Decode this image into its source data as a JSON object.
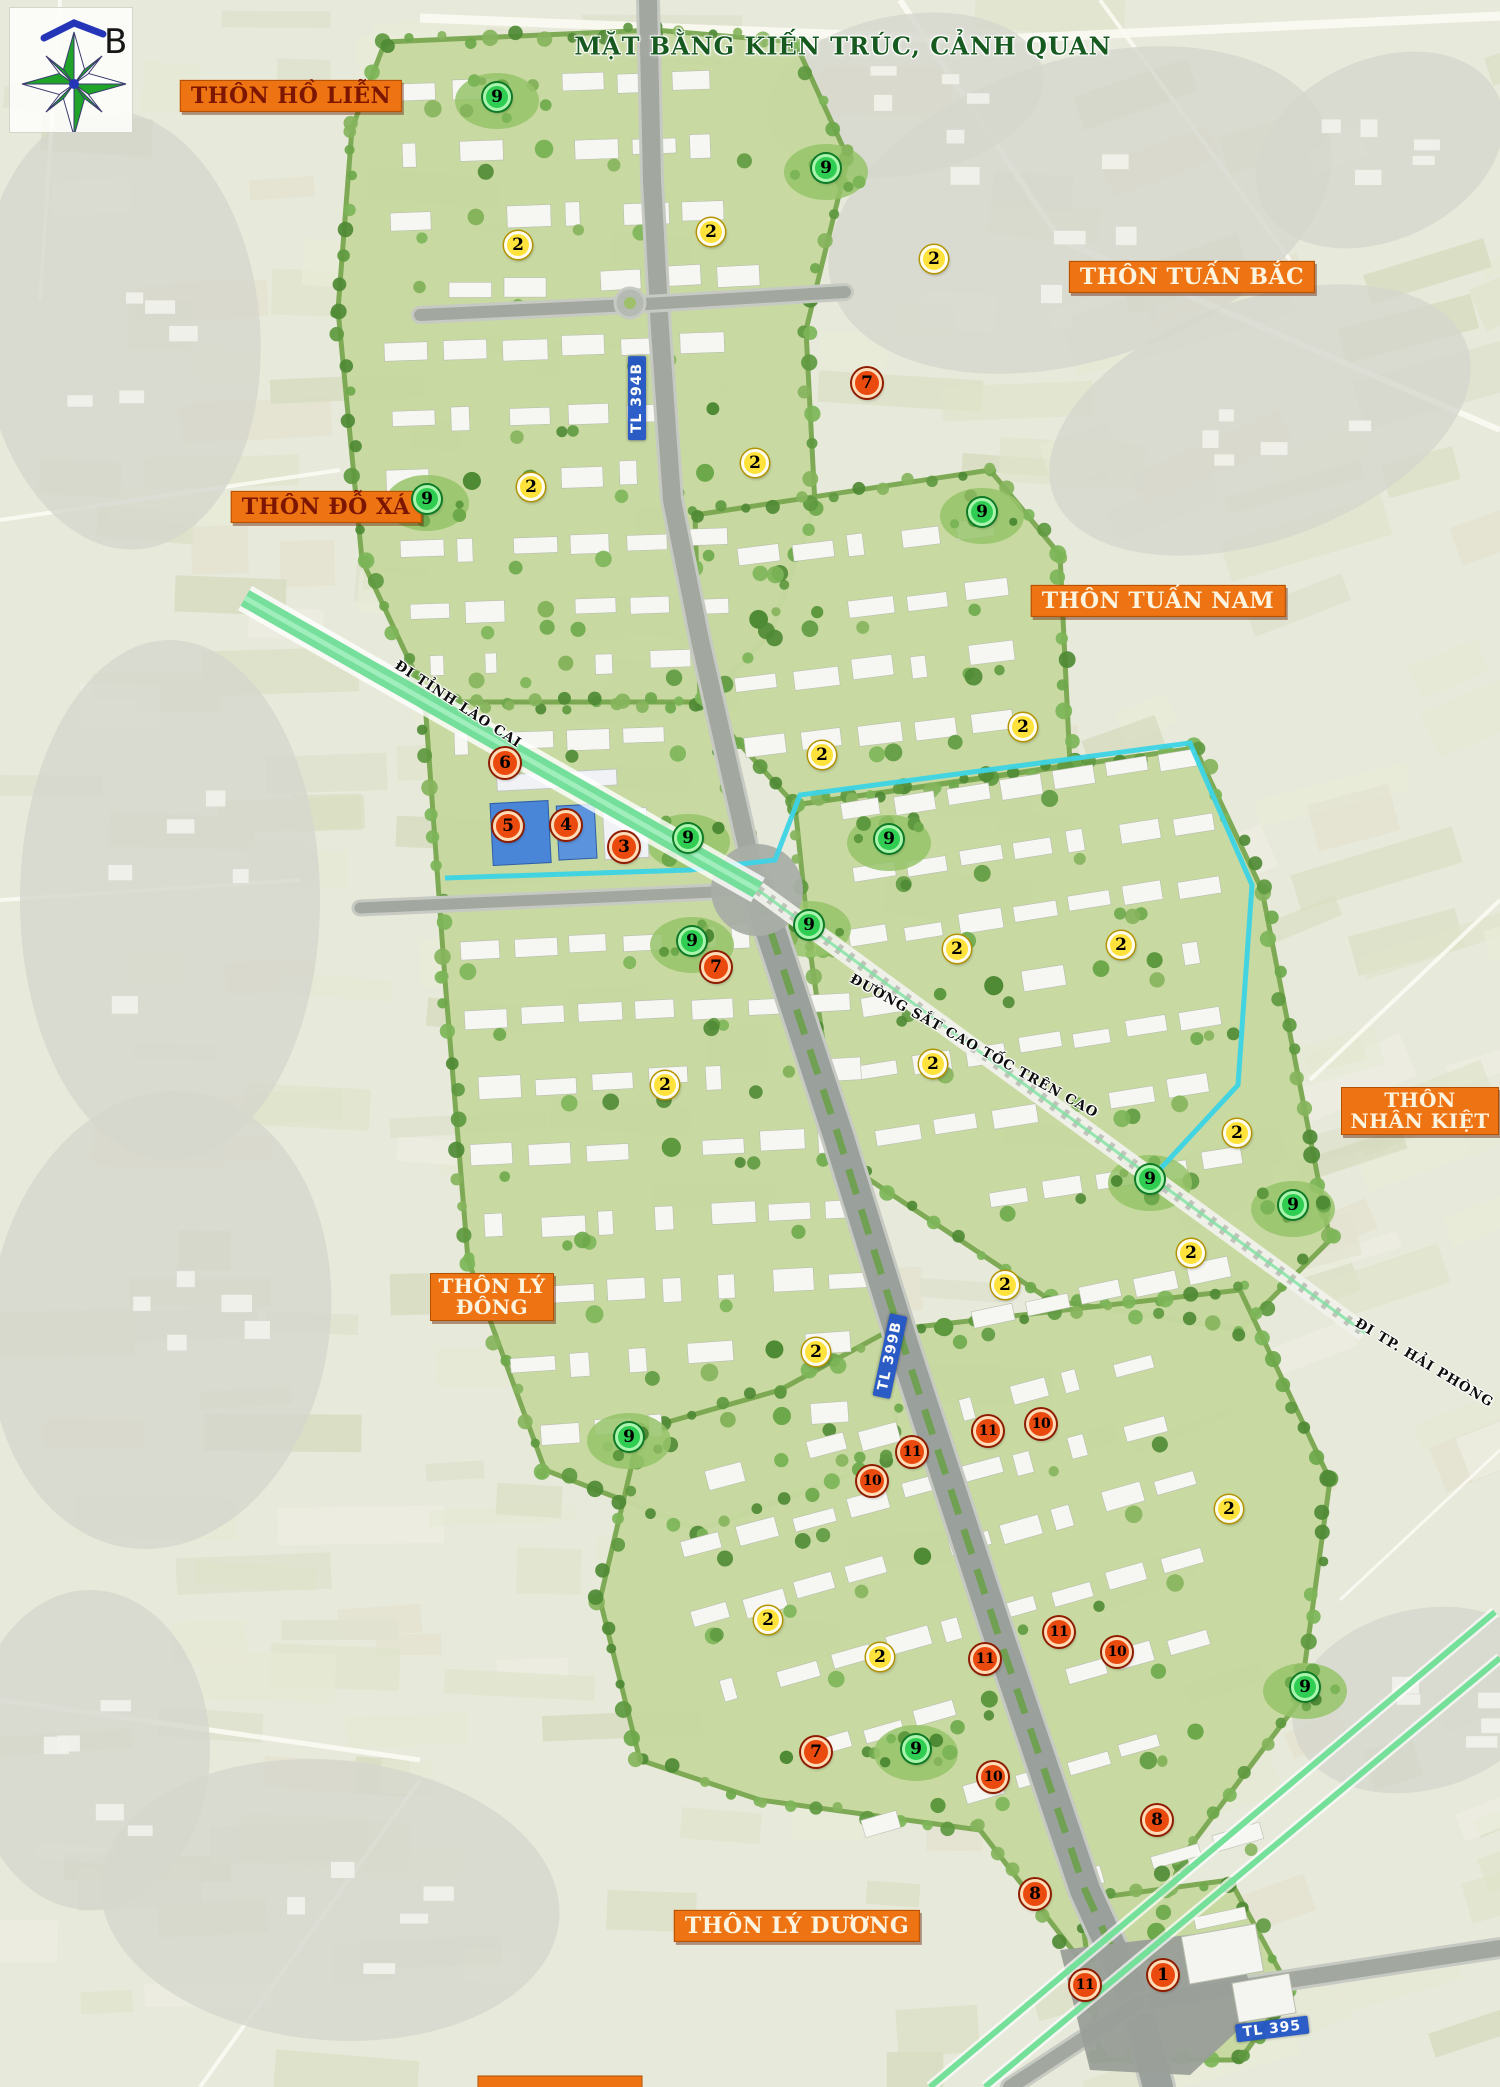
{
  "title": "MẶT BẰNG KIẾN TRÚC, CẢNH QUAN",
  "compass": {
    "north_label": "B"
  },
  "village_labels": [
    {
      "text": "THÔN HỒ LIỄN",
      "x": 291,
      "y": 96,
      "variant": "dark",
      "two_line": false
    },
    {
      "text": "THÔN TUẤN BẮC",
      "x": 1192,
      "y": 277,
      "variant": "light",
      "two_line": false
    },
    {
      "text": "THÔN ĐỖ XÁ",
      "x": 326,
      "y": 507,
      "variant": "dark",
      "two_line": false
    },
    {
      "text": "THÔN TUẤN NAM",
      "x": 1158,
      "y": 601,
      "variant": "light",
      "two_line": false
    },
    {
      "text": "THÔN NHÂN KIỆT",
      "x": 1420,
      "y": 1111,
      "variant": "light",
      "two_line": true,
      "w": 158
    },
    {
      "text": "THÔN LÝ ĐÔNG",
      "x": 492,
      "y": 1297,
      "variant": "light",
      "two_line": true,
      "w": 124
    },
    {
      "text": "THÔN LÝ DƯƠNG",
      "x": 797,
      "y": 1926,
      "variant": "light",
      "two_line": false
    },
    {
      "text": "",
      "x": 560,
      "y": 2083,
      "variant": "light",
      "two_line": false,
      "w": 165,
      "cut_off": true
    }
  ],
  "road_labels": [
    {
      "text": "TL 394B",
      "x": 637,
      "y": 398,
      "rot": -90
    },
    {
      "text": "TL 399B",
      "x": 890,
      "y": 1356,
      "rot": -78
    },
    {
      "text": "TL 395",
      "x": 1272,
      "y": 2029,
      "rot": -7
    }
  ],
  "direction_labels": [
    {
      "text": "ĐI TỈNH LÀO CAI",
      "x": 396,
      "y": 656,
      "rot": 33
    },
    {
      "text": "ĐƯỜNG SẮT CAO TỐC TRÊN CAO",
      "x": 851,
      "y": 970,
      "rot": 29
    },
    {
      "text": "ĐI TP. HẢI PHÒNG",
      "x": 1356,
      "y": 1314,
      "rot": 31
    }
  ],
  "markers": [
    {
      "n": "9",
      "color": "green",
      "x": 497,
      "y": 97
    },
    {
      "n": "9",
      "color": "green",
      "x": 826,
      "y": 168
    },
    {
      "n": "9",
      "color": "green",
      "x": 427,
      "y": 499
    },
    {
      "n": "9",
      "color": "green",
      "x": 982,
      "y": 512
    },
    {
      "n": "9",
      "color": "green",
      "x": 688,
      "y": 838
    },
    {
      "n": "9",
      "color": "green",
      "x": 889,
      "y": 839
    },
    {
      "n": "9",
      "color": "green",
      "x": 809,
      "y": 925
    },
    {
      "n": "9",
      "color": "green",
      "x": 692,
      "y": 941
    },
    {
      "n": "9",
      "color": "green",
      "x": 1150,
      "y": 1179
    },
    {
      "n": "9",
      "color": "green",
      "x": 1293,
      "y": 1205
    },
    {
      "n": "9",
      "color": "green",
      "x": 629,
      "y": 1437
    },
    {
      "n": "9",
      "color": "green",
      "x": 1305,
      "y": 1687
    },
    {
      "n": "9",
      "color": "green",
      "x": 916,
      "y": 1749
    },
    {
      "n": "2",
      "color": "yellow",
      "x": 518,
      "y": 245
    },
    {
      "n": "2",
      "color": "yellow",
      "x": 711,
      "y": 232
    },
    {
      "n": "2",
      "color": "yellow",
      "x": 934,
      "y": 259
    },
    {
      "n": "2",
      "color": "yellow",
      "x": 755,
      "y": 463
    },
    {
      "n": "2",
      "color": "yellow",
      "x": 531,
      "y": 487
    },
    {
      "n": "2",
      "color": "yellow",
      "x": 1023,
      "y": 727
    },
    {
      "n": "2",
      "color": "yellow",
      "x": 822,
      "y": 755
    },
    {
      "n": "2",
      "color": "yellow",
      "x": 957,
      "y": 949
    },
    {
      "n": "2",
      "color": "yellow",
      "x": 1121,
      "y": 945
    },
    {
      "n": "2",
      "color": "yellow",
      "x": 665,
      "y": 1085
    },
    {
      "n": "2",
      "color": "yellow",
      "x": 933,
      "y": 1064
    },
    {
      "n": "2",
      "color": "yellow",
      "x": 1237,
      "y": 1133
    },
    {
      "n": "2",
      "color": "yellow",
      "x": 1005,
      "y": 1285
    },
    {
      "n": "2",
      "color": "yellow",
      "x": 1191,
      "y": 1253
    },
    {
      "n": "2",
      "color": "yellow",
      "x": 816,
      "y": 1352
    },
    {
      "n": "2",
      "color": "yellow",
      "x": 1229,
      "y": 1509
    },
    {
      "n": "2",
      "color": "yellow",
      "x": 768,
      "y": 1620
    },
    {
      "n": "2",
      "color": "yellow",
      "x": 880,
      "y": 1657
    },
    {
      "n": "7",
      "color": "red",
      "x": 867,
      "y": 383
    },
    {
      "n": "6",
      "color": "red",
      "x": 505,
      "y": 763
    },
    {
      "n": "5",
      "color": "red",
      "x": 508,
      "y": 826
    },
    {
      "n": "4",
      "color": "red",
      "x": 566,
      "y": 825
    },
    {
      "n": "3",
      "color": "red",
      "x": 624,
      "y": 847
    },
    {
      "n": "7",
      "color": "red",
      "x": 716,
      "y": 967
    },
    {
      "n": "11",
      "color": "red",
      "x": 912,
      "y": 1452
    },
    {
      "n": "11",
      "color": "red",
      "x": 988,
      "y": 1431
    },
    {
      "n": "10",
      "color": "red",
      "x": 1041,
      "y": 1424
    },
    {
      "n": "10",
      "color": "red",
      "x": 872,
      "y": 1481
    },
    {
      "n": "11",
      "color": "red",
      "x": 1059,
      "y": 1632
    },
    {
      "n": "10",
      "color": "red",
      "x": 1117,
      "y": 1652
    },
    {
      "n": "11",
      "color": "red",
      "x": 985,
      "y": 1659
    },
    {
      "n": "7",
      "color": "red",
      "x": 816,
      "y": 1752
    },
    {
      "n": "10",
      "color": "red",
      "x": 993,
      "y": 1777
    },
    {
      "n": "8",
      "color": "red",
      "x": 1157,
      "y": 1820
    },
    {
      "n": "8",
      "color": "red",
      "x": 1035,
      "y": 1894
    },
    {
      "n": "11",
      "color": "red",
      "x": 1085,
      "y": 1985
    },
    {
      "n": "1",
      "color": "red",
      "x": 1163,
      "y": 1975
    }
  ],
  "colors": {
    "village_label_bg": "#ee7413",
    "village_label_text_dark": "#7c1600",
    "village_label_text_light": "#fdf4df",
    "title_green": "#175a20",
    "road_sign_blue": "#2356c7",
    "marker_red": "#ea4a0e",
    "marker_yellow": "#ffe33c",
    "marker_green": "#2fce52",
    "canal_cyan": "#3cd4e6",
    "rail_corridor_green": "#67dd92"
  }
}
